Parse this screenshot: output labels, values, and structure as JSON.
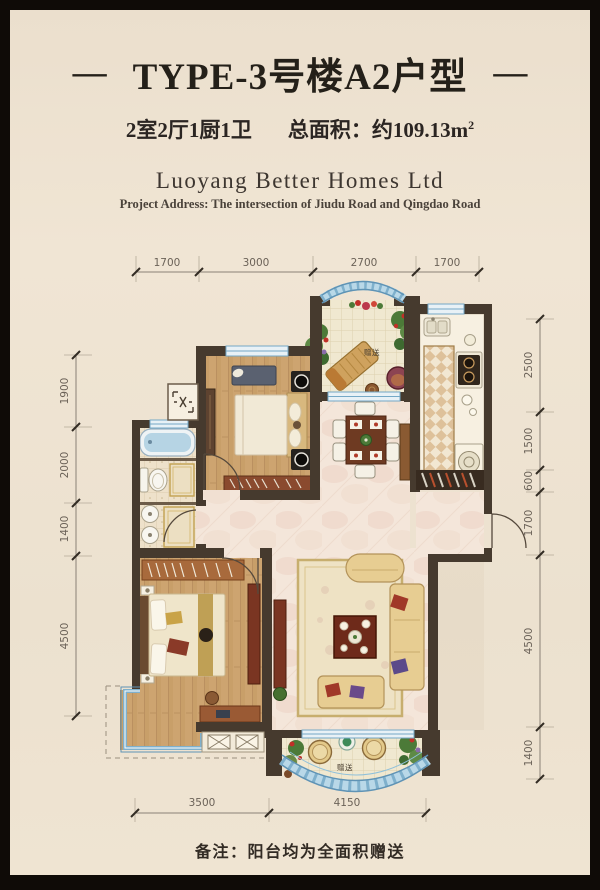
{
  "colors": {
    "background": "#ede2d1",
    "frame": "#0f0b07",
    "wall": "#463a2e",
    "accent_blue": "#7fb0cc",
    "wood": "#cda470",
    "marble": "#f4e6da",
    "title_text": "#242019",
    "dim_text": "#6b6258"
  },
  "header": {
    "dash": "—",
    "title": "TYPE-3号楼A2户型",
    "specs_rooms": "2室2厅1厨1卫",
    "area_label": "总面积：约109.13m",
    "area_sup": "2",
    "company": "Luoyang Better Homes Ltd",
    "address": "Project Address: The intersection of Jiudu Road and Qingdao Road"
  },
  "plan": {
    "dims_top": [
      "1700",
      "3000",
      "2700",
      "1700"
    ],
    "dims_left": [
      "1900",
      "2000",
      "1400",
      "4500"
    ],
    "dims_right": [
      "2500",
      "1500",
      "600",
      "1700",
      "4500",
      "1400"
    ],
    "dims_bottom": [
      "3500",
      "4150"
    ],
    "gift_top": "赠送",
    "gift_bottom": "赠送"
  },
  "footer": {
    "note": "备注：阳台均为全面积赠送"
  }
}
